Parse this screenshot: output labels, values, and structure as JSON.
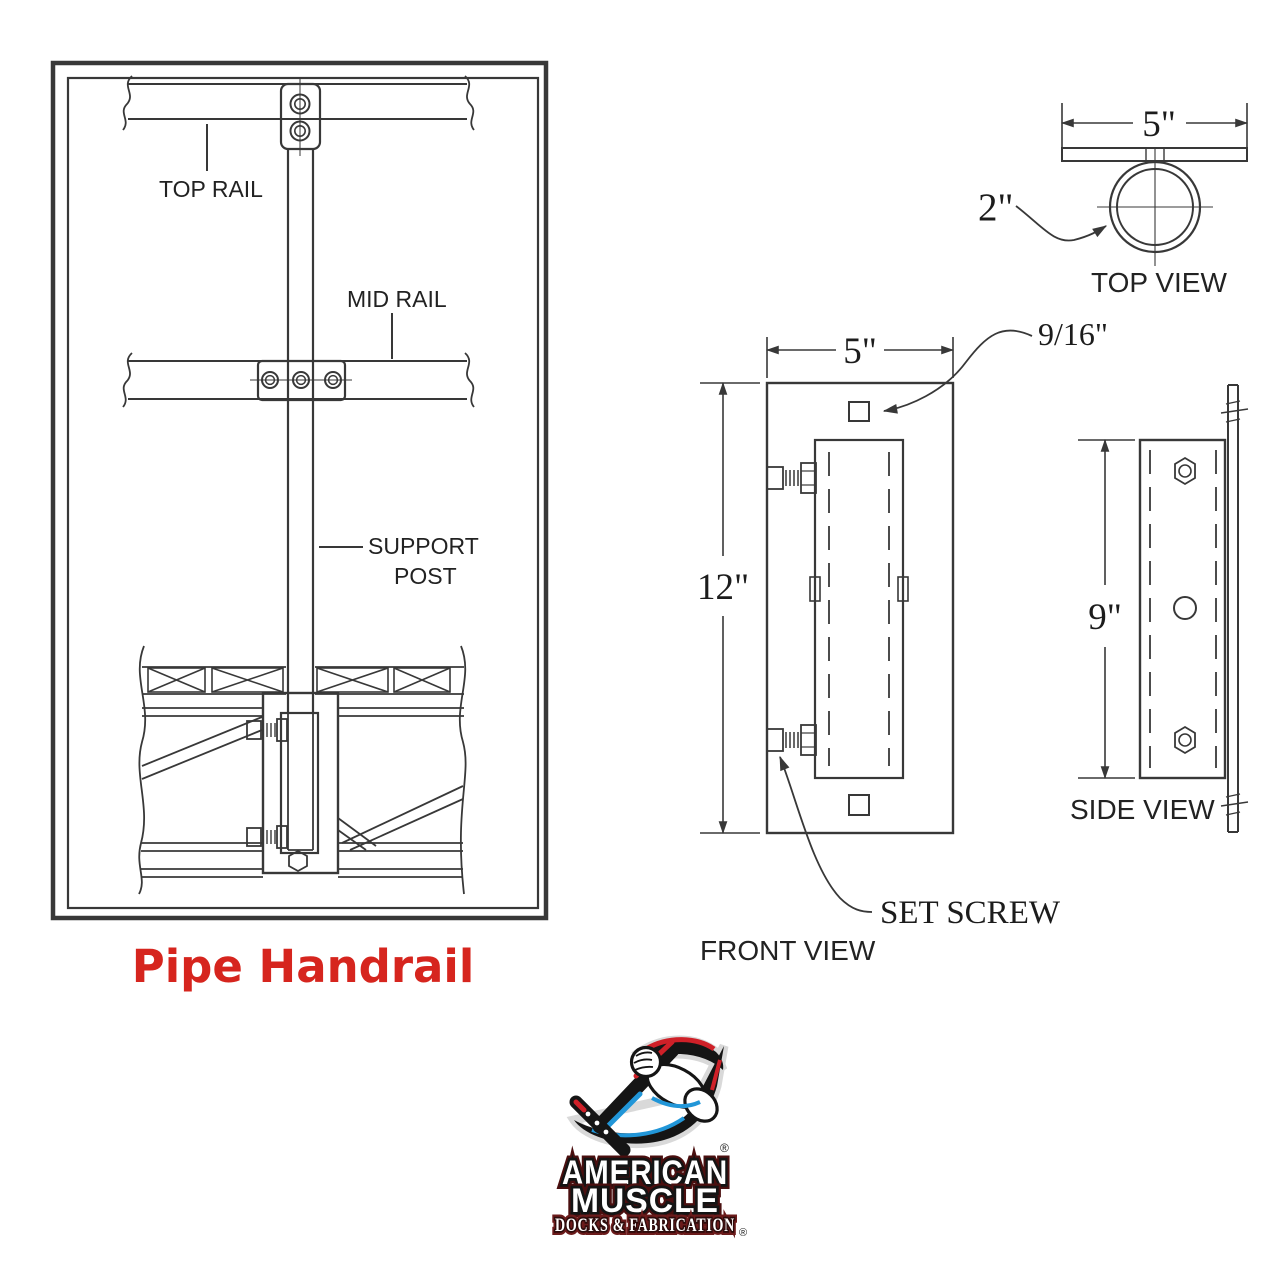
{
  "drawing": {
    "left_panel": {
      "caption": "Pipe Handrail",
      "labels": {
        "top_rail": "TOP RAIL",
        "mid_rail": "MID RAIL",
        "support_post_line1": "SUPPORT",
        "support_post_line2": "POST"
      }
    },
    "top_view": {
      "label": "TOP VIEW",
      "width_dim": "5\"",
      "pipe_dim": "2\""
    },
    "front_view": {
      "label": "FRONT VIEW",
      "width_dim": "5\"",
      "height_dim": "12\"",
      "hole_dim": "9/16\"",
      "set_screw_label": "SET SCREW"
    },
    "side_view": {
      "label": "SIDE VIEW",
      "height_dim": "9\""
    },
    "colors": {
      "line": "#383838",
      "caption_red": "#d6251e",
      "logo_red": "#cf2028",
      "logo_blue": "#2196d8",
      "logo_maroon": "#6b1b1b"
    }
  },
  "logo": {
    "line1": "AMERICAN",
    "line2": "MUSCLE",
    "line3": "DOCKS & FABRICATION",
    "registered": "®"
  }
}
